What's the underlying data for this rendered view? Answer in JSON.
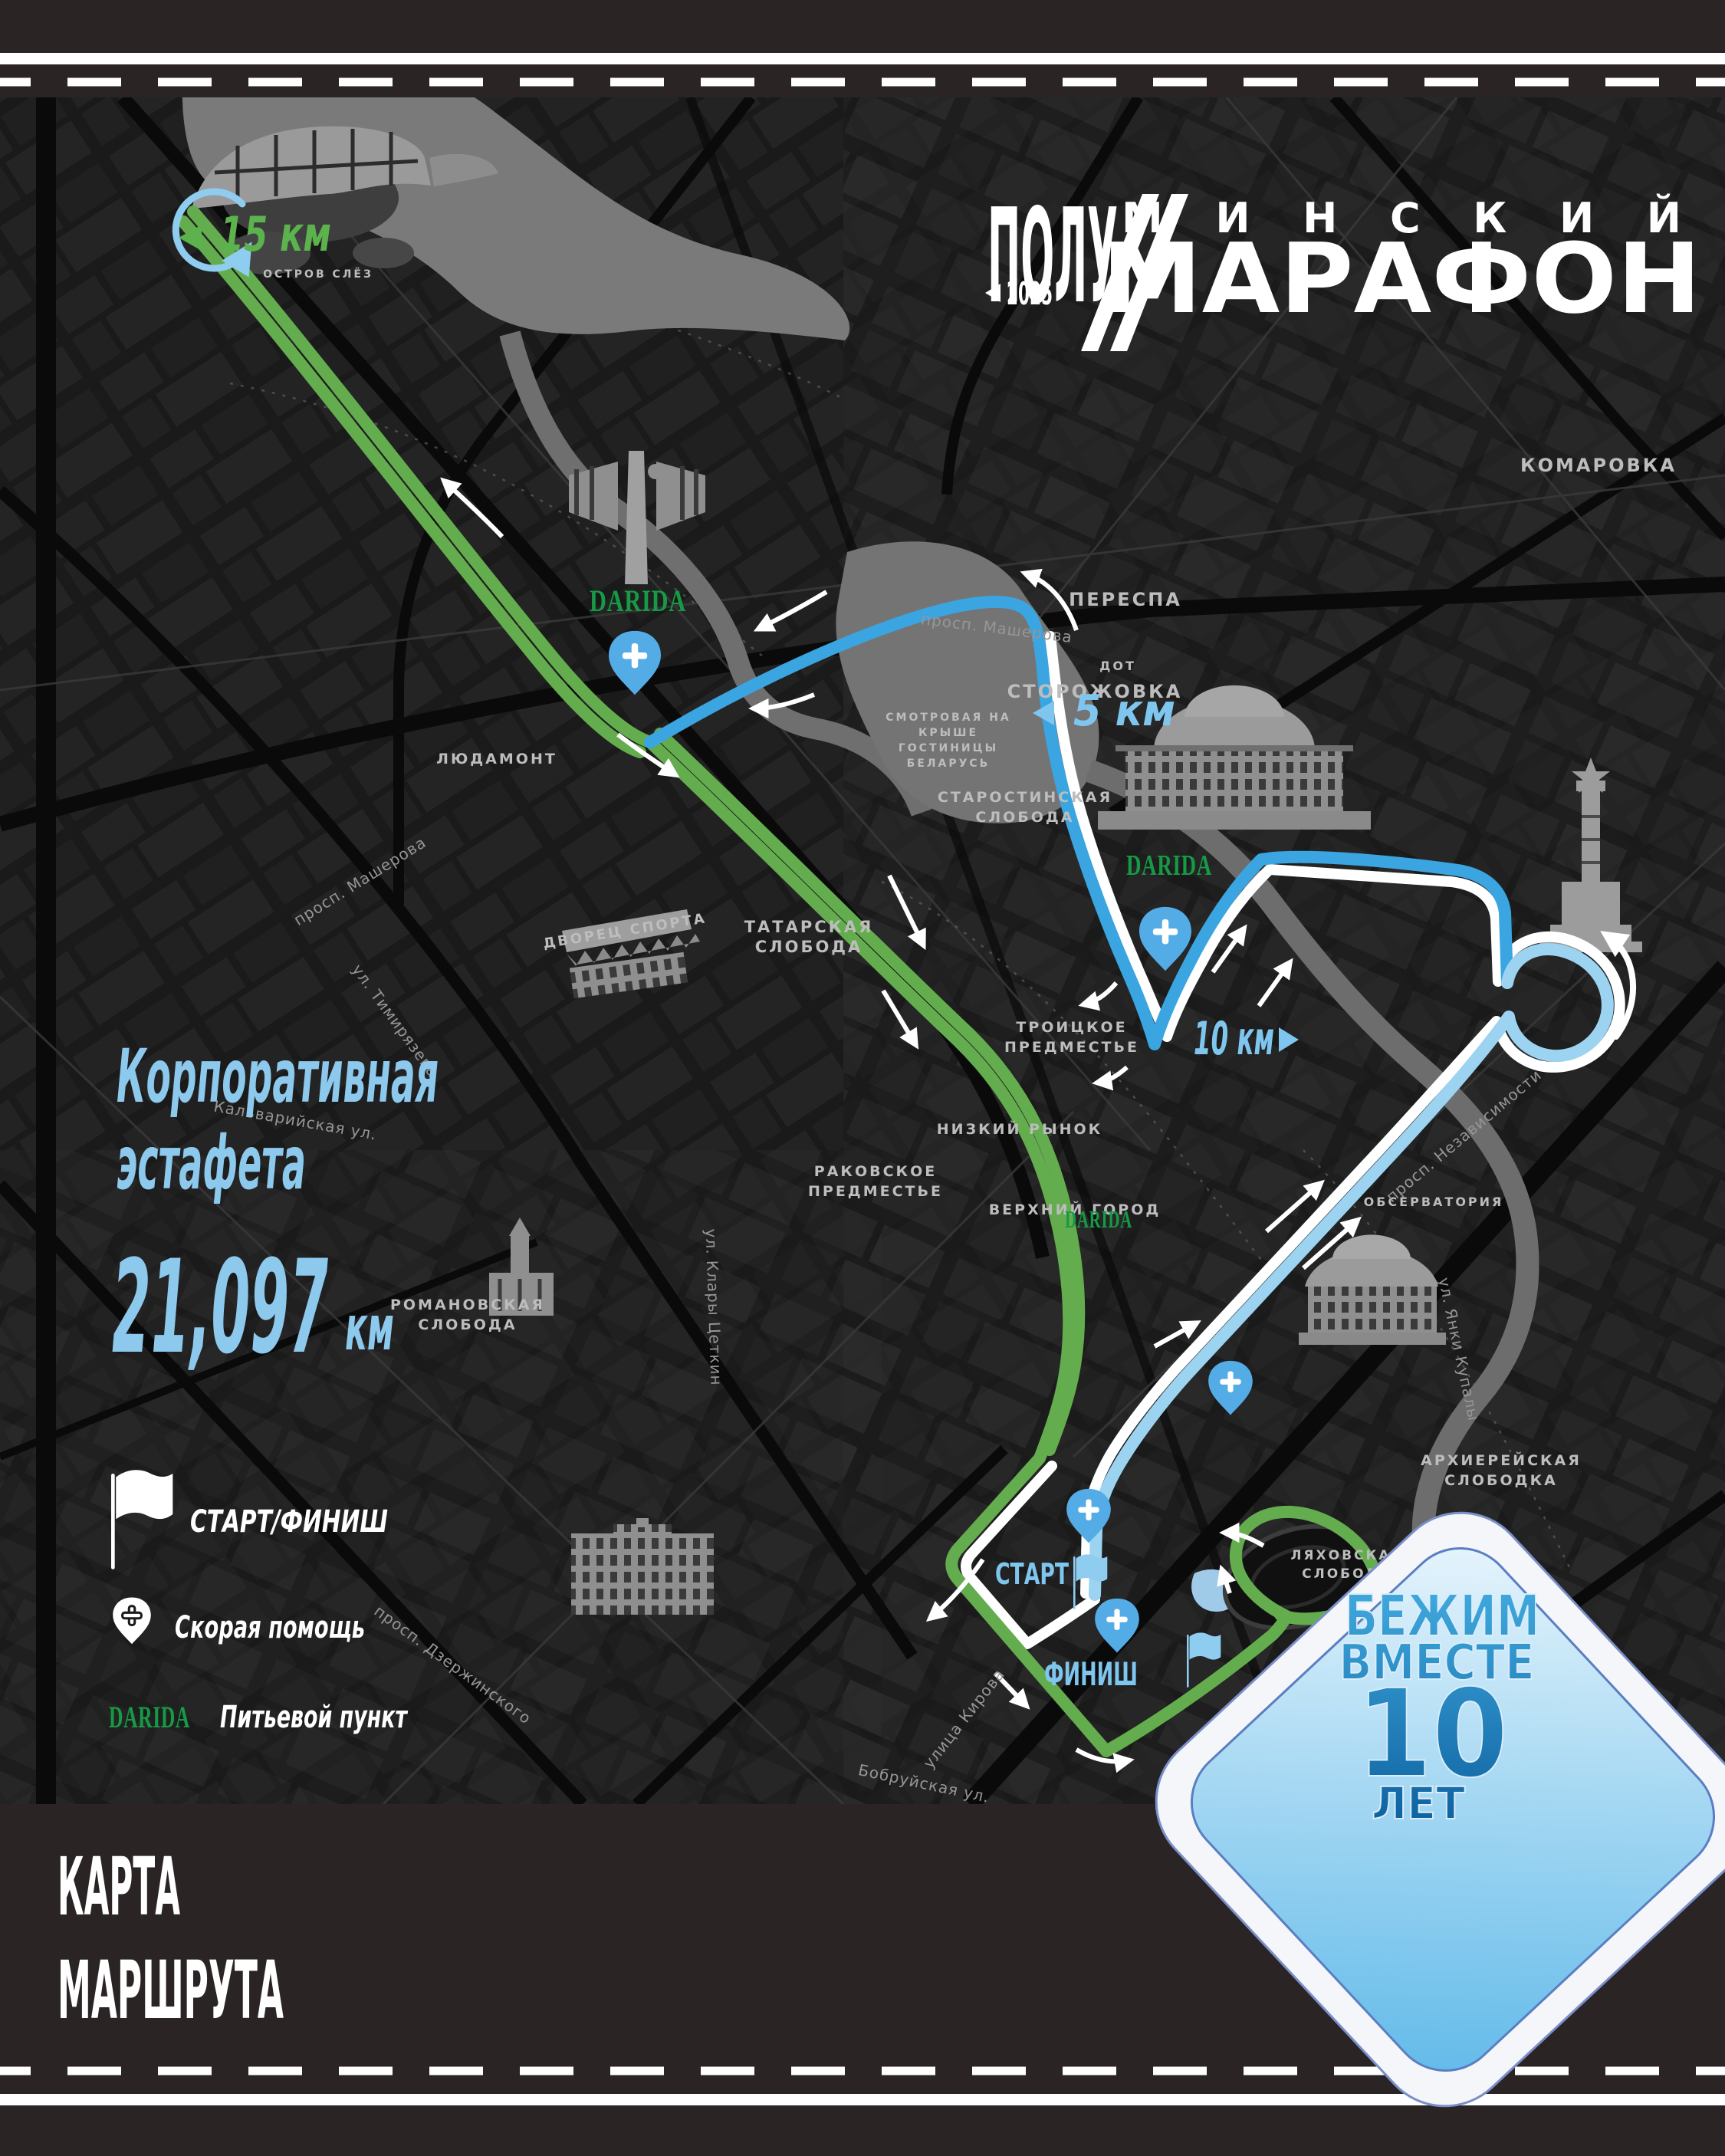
{
  "logo": {
    "top_left": "ПОЛУ",
    "top_right": "МИНСКИЙ",
    "bottom": "МАРАФОН",
    "year": "2025"
  },
  "headline": {
    "line1": "Корпоративная",
    "line2": "эстафета",
    "distance": "21,097",
    "unit": "км"
  },
  "km_markers": {
    "km15": "15 км",
    "km5": "5 км",
    "km10": "10 км"
  },
  "course": {
    "start": "СТАРТ",
    "finish": "ФИНИШ"
  },
  "legend": {
    "start_finish": "СТАРТ/ФИНИШ",
    "medical": "Скорая помощь",
    "water": "Питьевой пункт"
  },
  "sponsor": {
    "name": "DARIDA"
  },
  "footer": {
    "line1": "КАРТА",
    "line2": "МАРШРУТА"
  },
  "badge": {
    "line1": "БЕЖИМ",
    "line2": "ВМЕСТЕ",
    "number": "10",
    "line3": "ЛЕТ"
  },
  "icons": {
    "flag": "flag-icon",
    "medical_pin": "medical-pin-icon",
    "km_left": "left-triangle-icon",
    "km_right": "right-triangle-icon",
    "year_left": "left-triangle-icon"
  },
  "colors": {
    "band": "#2b2424",
    "map_bg": "#181818",
    "route_green": "#64ad4e",
    "route_blue": "#3aa5e0",
    "route_light_blue": "#9bd3f1",
    "route_white": "#ffffff",
    "accent_text": "#8cc9ed",
    "km15_green": "#5cb24c",
    "sponsor_green": "#169a45",
    "badge_text_blue": "#1b7fc0",
    "water_gray": "#757575"
  },
  "map": {
    "districts": [
      "КОМАРОВКА",
      "ПЕРЕСПА",
      "СТОРОЖОВКА",
      "ДОТ",
      "СТАРОСТИНСКАЯ",
      "СЛОБОДА",
      "ТРОИЦКОЕ",
      "ПРЕДМЕСТЬЕ",
      "ТАТАРСКАЯ",
      "СЛОБОДА",
      "РАКОВСКОЕ",
      "ПРЕДМЕСТЬЕ",
      "НИЗКИЙ РЫНОК",
      "ВЕРХНИЙ ГОРОД",
      "РОМАНОВСКАЯ",
      "СЛОБОДА",
      "ЛЮДАМОНТ",
      "АРХИЕРЕЙСКАЯ",
      "СЛОБОДКА",
      "ОБСЕРВАТОРИЯ",
      "ЛЯХОВСКАЯ",
      "СЛОБОДА",
      "СМОТРОВАЯ НА",
      "КРЫШЕ",
      "ГОСТИНИЦЫ",
      "БЕЛАРУСЬ",
      "ДВОРЕЦ СПОРТА",
      "ОСТРОВ СЛЁЗ"
    ],
    "streets": [
      "просп. Машерова",
      "просп. Машерова",
      "просп. Независимости",
      "Кальварийская ул.",
      "ул. Тимирязева",
      "Бобруйская ул.",
      "ул. Клары Цеткин",
      "просп. Дзержинского",
      "улица Кирова",
      "ул. Янки Купалы"
    ]
  }
}
